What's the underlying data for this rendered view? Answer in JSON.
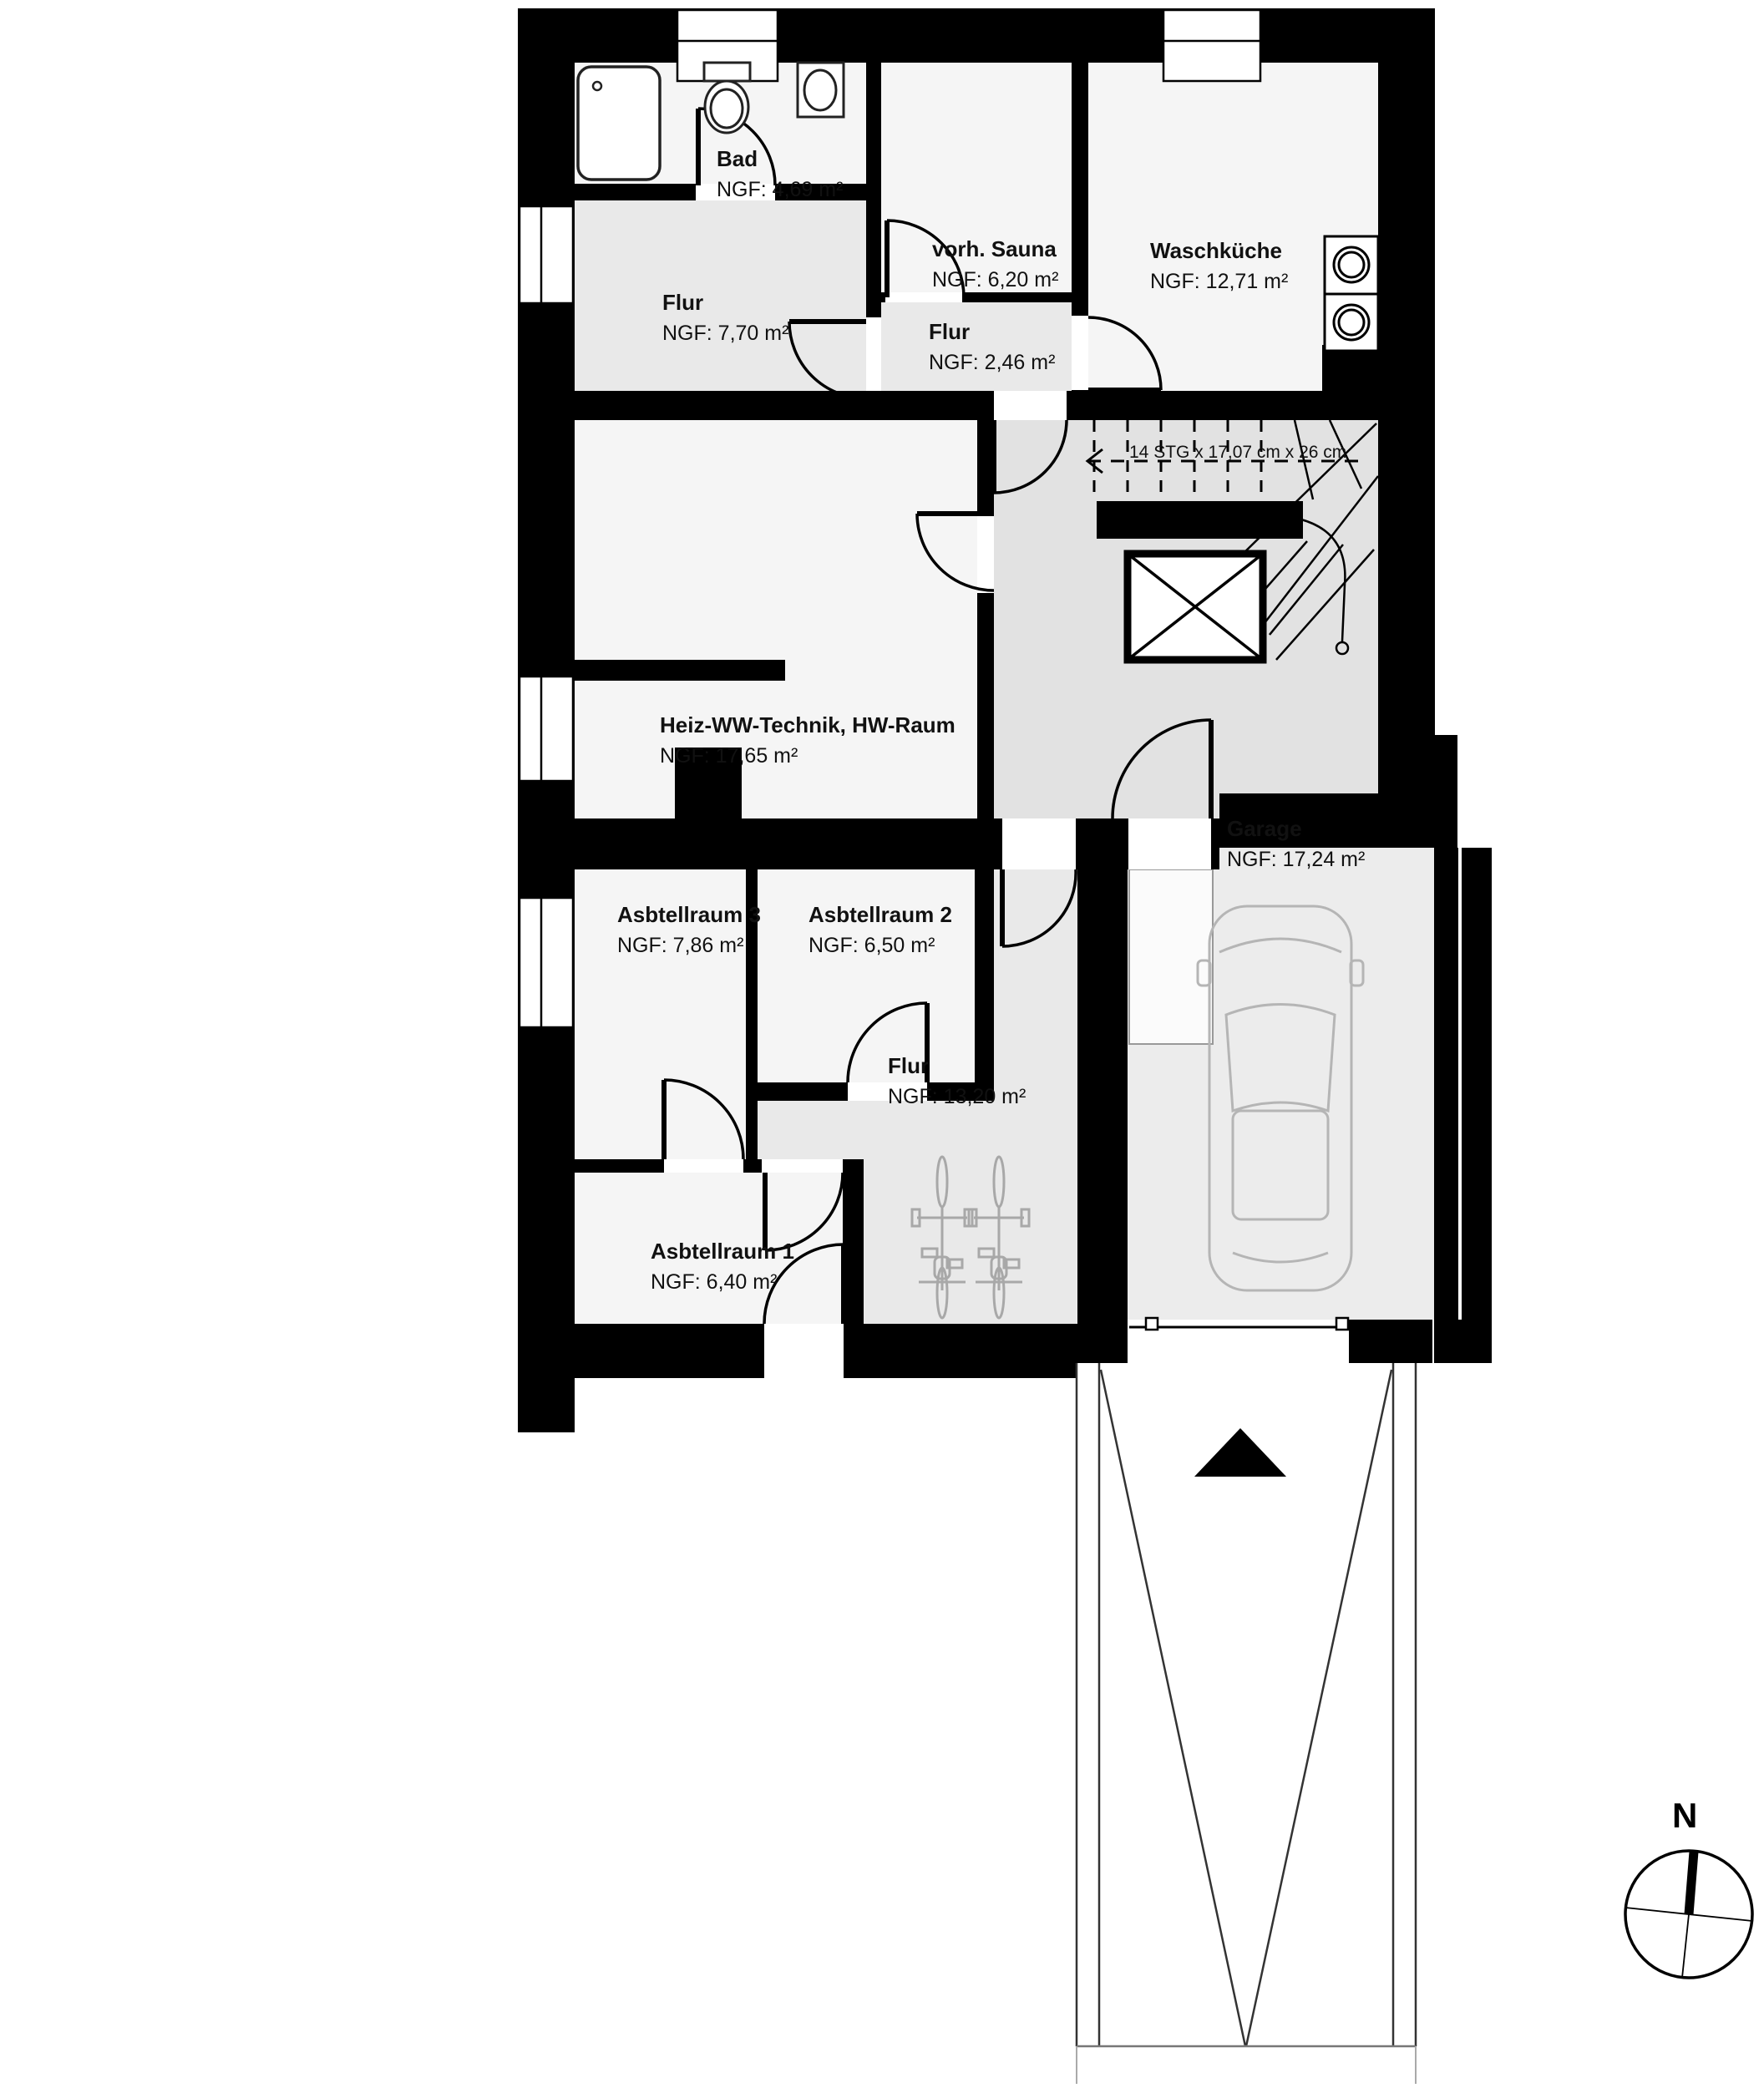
{
  "rooms": [
    {
      "id": "bad",
      "name": "Bad",
      "area": "NGF: 4,69 m²"
    },
    {
      "id": "vorh-sauna",
      "name": "vorh. Sauna",
      "area": "NGF: 6,20 m²"
    },
    {
      "id": "waschkueche",
      "name": "Waschküche",
      "area": "NGF: 12,71 m²"
    },
    {
      "id": "flur-770",
      "name": "Flur",
      "area": "NGF: 7,70 m²"
    },
    {
      "id": "flur-246",
      "name": "Flur",
      "area": "NGF: 2,46 m²"
    },
    {
      "id": "heiz-ww-technik",
      "name": "Heiz-WW-Technik, HW-Raum",
      "area": "NGF: 17,65 m²"
    },
    {
      "id": "asbtellraum-3",
      "name": "Asbtellraum 3",
      "area": "NGF: 7,86 m²"
    },
    {
      "id": "asbtellraum-2",
      "name": "Asbtellraum 2",
      "area": "NGF: 6,50 m²"
    },
    {
      "id": "flur-1320",
      "name": "Flur",
      "area": "NGF: 13,20 m²"
    },
    {
      "id": "asbtellraum-1",
      "name": "Asbtellraum 1",
      "area": "NGF: 6,40 m²"
    },
    {
      "id": "garage",
      "name": "Garage",
      "area": "NGF: 17,24 m²"
    }
  ],
  "stairs": {
    "note": "14 STG x 17,07 cm x 26 cm"
  },
  "compass": {
    "label": "N"
  },
  "fixtures": [
    "bathtub",
    "toilet",
    "sink",
    "washer",
    "dryer",
    "car",
    "bicycle",
    "bicycle",
    "shaft",
    "chimney"
  ],
  "colors": {
    "wall": "#000000",
    "room_light": "#f5f5f5",
    "corridor": "#e9e9e9",
    "stair_hall": "#e2e2e2",
    "garage_floor": "#ececec",
    "vehicle_gray": "#b5b5b5"
  }
}
